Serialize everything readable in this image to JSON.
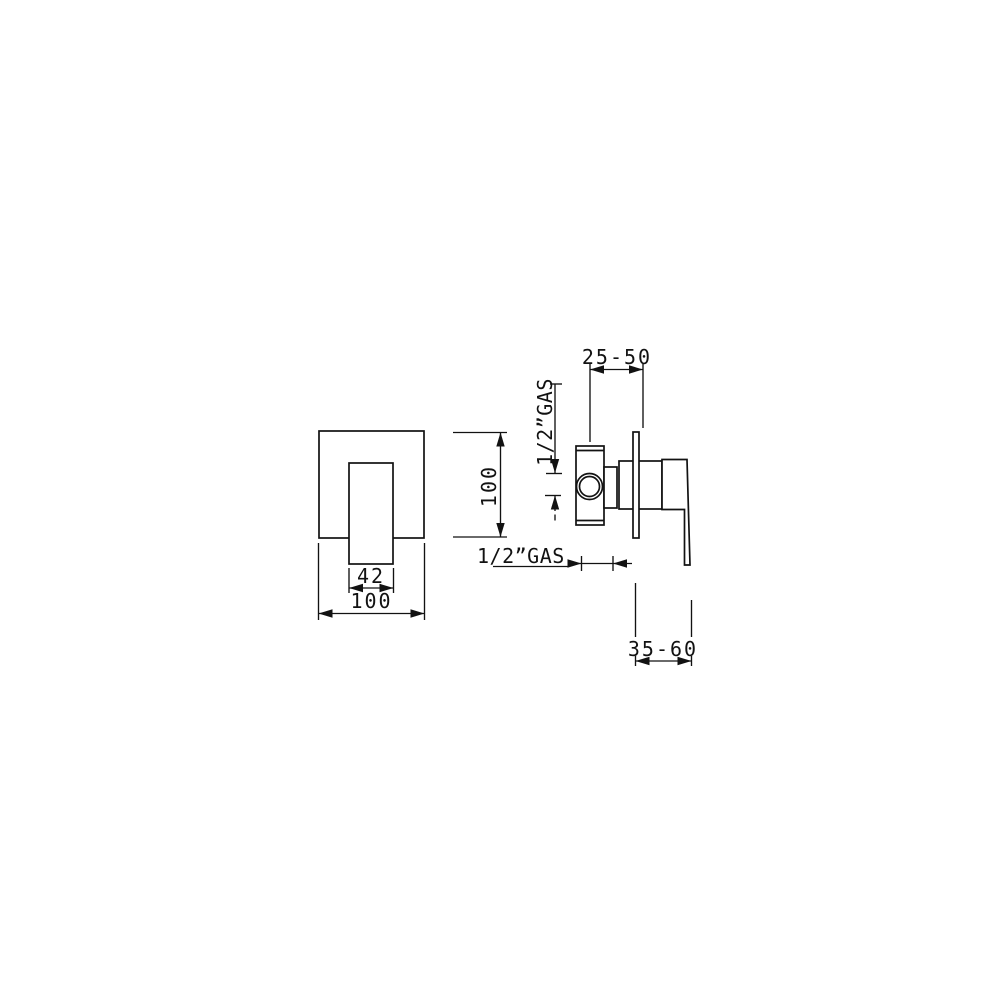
{
  "colors": {
    "background": "#ffffff",
    "ink": "#121212"
  },
  "drawing": {
    "front_view": {
      "handle_width": "42",
      "plate_width": "100",
      "plate_height": "100"
    },
    "side_view": {
      "recess_depth_range": "25-50",
      "top_thread_label": "1/2”GAS",
      "bottom_thread_label": "1/2”GAS",
      "projection_range": "35-60"
    }
  }
}
